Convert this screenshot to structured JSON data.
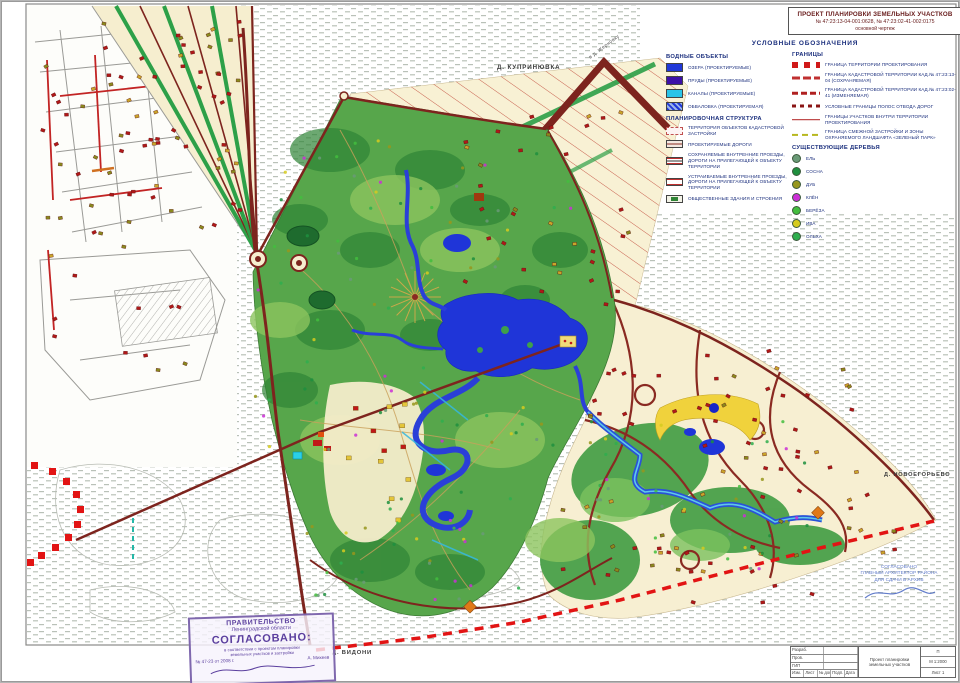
{
  "title_block": {
    "line1": "ПРОЕКТ ПЛАНИРОВКИ  ЗЕМЕЛЬНЫХ УЧАСТКОВ",
    "line2": "№ 47:23:13-04-001:0628,  № 47:23:02-41-002:0175",
    "line3": "основной чертеж"
  },
  "legend": {
    "title": "УСЛОВНЫЕ ОБОЗНАЧЕНИЯ",
    "water": {
      "title": "ВОДНЫЕ ОБЪЕКТЫ",
      "items": [
        {
          "label": "ОЗЕРА (ПРОЕКТИРУЕМЫЕ)"
        },
        {
          "label": "ПРУДЫ (ПРОЕКТИРУЕМЫЕ)"
        },
        {
          "label": "КАНАЛЫ (ПРОЕКТИРУЕМЫЕ)"
        },
        {
          "label": "ОБВАЛОВКА (ПРОЕКТИРУЕМАЯ)"
        }
      ]
    },
    "planning": {
      "title": "ПЛАНИРОВОЧНАЯ СТРУКТУРА",
      "items": [
        {
          "label": "ТЕРРИТОРИЯ ОБЪЕКТОВ КАДАСТРОВОЙ ЗАСТРОЙКИ"
        },
        {
          "label": "ПРОЕКТИРУЕМЫЕ ДОРОГИ"
        },
        {
          "label": "СОХРАНЯЕМЫЕ ВНУТРЕННИЕ ПРОЕЗДЫ, ДОРОГИ НА ПРИЛЕГАЮЩЕЙ К ОБЪЕКТУ ТЕРРИТОРИИ"
        },
        {
          "label": "УСТРАИВАЕМЫЕ ВНУТРЕННИЕ ПРОЕЗДЫ, ДОРОГИ НА ПРИЛЕГАЮЩЕЙ К ОБЪЕКТУ ТЕРРИТОРИИ"
        },
        {
          "label": "ОБЩЕСТВЕННЫЕ ЗДАНИЯ И СТРОЕНИЯ"
        }
      ]
    },
    "borders": {
      "title": "ГРАНИЦЫ",
      "items": [
        {
          "label": "ГРАНИЦА ТЕРРИТОРИИ ПРОЕКТИРОВАНИЯ"
        },
        {
          "label": "ГРАНИЦА КАДАСТРОВОЙ ТЕРРИТОРИИ КАД.№ 47:23:13-04 (СОХРАНЯЕМАЯ)"
        },
        {
          "label": "ГРАНИЦА КАДАСТРОВОЙ ТЕРРИТОРИИ КАД.№ 47:23:02-41 (ИЗМЕНЯЕМАЯ)"
        },
        {
          "label": "УСЛОВНЫЕ ГРАНИЦЫ ПОЛОС ОТВОДА ДОРОГ"
        },
        {
          "label": "ГРАНИЦЫ УЧАСТКОВ ВНУТРИ ТЕРРИТОРИИ ПРОЕКТИРОВАНИЯ"
        },
        {
          "label": "ГРАНИЦА СМЕЖНОЙ ЗАСТРОЙКИ И ЗОНЫ ОХРАНЯЕМОГО ЛАНДШАФТА «ЗЕЛЕНЫЙ ПАРК»"
        }
      ]
    },
    "trees": {
      "title": "СУЩЕСТВУЮЩИЕ ДЕРЕВЬЯ",
      "items": [
        {
          "label": "ЕЛЬ",
          "color": "#6a9a77"
        },
        {
          "label": "СОСНА",
          "color": "#1e8f3e"
        },
        {
          "label": "ДУБ",
          "color": "#97971d"
        },
        {
          "label": "КЛЁН",
          "color": "#cb2fd6"
        },
        {
          "label": "БЕРЁЗА",
          "color": "#43bd3e"
        },
        {
          "label": "ИВА",
          "color": "#d6cb1e"
        },
        {
          "label": "ОЛЬХА",
          "color": "#2fae4e"
        }
      ]
    }
  },
  "map_labels": {
    "village_top": "Д. КУПРИНЮВКА",
    "road_note": "в д. Жерновку",
    "village_right": "Д. НОВОЕГОРЬЕВО",
    "village_bottom": "Д. ВИДОНИ"
  },
  "approval_stamp": {
    "line1": "ПРАВИТЕЛЬСТВО",
    "line2": "Ленинградской области",
    "line3": "СОГЛАСОВАНО:",
    "line4": "в соответствии с проектом планировки",
    "line5": "земельных участков и застройки",
    "line6": "№ 47-23 от 2008 г.",
    "signer": "А. Михеев"
  },
  "blue_note": {
    "line1": "СОГЛАСОВАНО",
    "line2": "ГЛАВНЫЙ АРХИТЕКТОР РАЙОНА",
    "line3": "ДЛЯ СДАЧИ В АРХИВ"
  },
  "sheet_stamp": {
    "r1": "Разраб.",
    "r2": "Пров.",
    "r3": "ГИП",
    "c_izm": "Изм.",
    "c_list": "Лист",
    "c_doc": "№ док.",
    "c_podp": "Подп.",
    "c_data": "Дата",
    "project": "Проект планировки земельных участков",
    "stage": "П",
    "scale": "М 1:2000",
    "sheet": "Лист 1"
  },
  "colors": {
    "accent_red": "#e21414",
    "road_maroon": "#7d241e",
    "park_green": "#57a64b",
    "lake_blue": "#1f35d8",
    "canal_cyan": "#2ac4e8",
    "parcel_cream": "#f8f1d4",
    "legend_navy": "#1b2f7d",
    "stamp_purple": "#6a4fa0"
  }
}
